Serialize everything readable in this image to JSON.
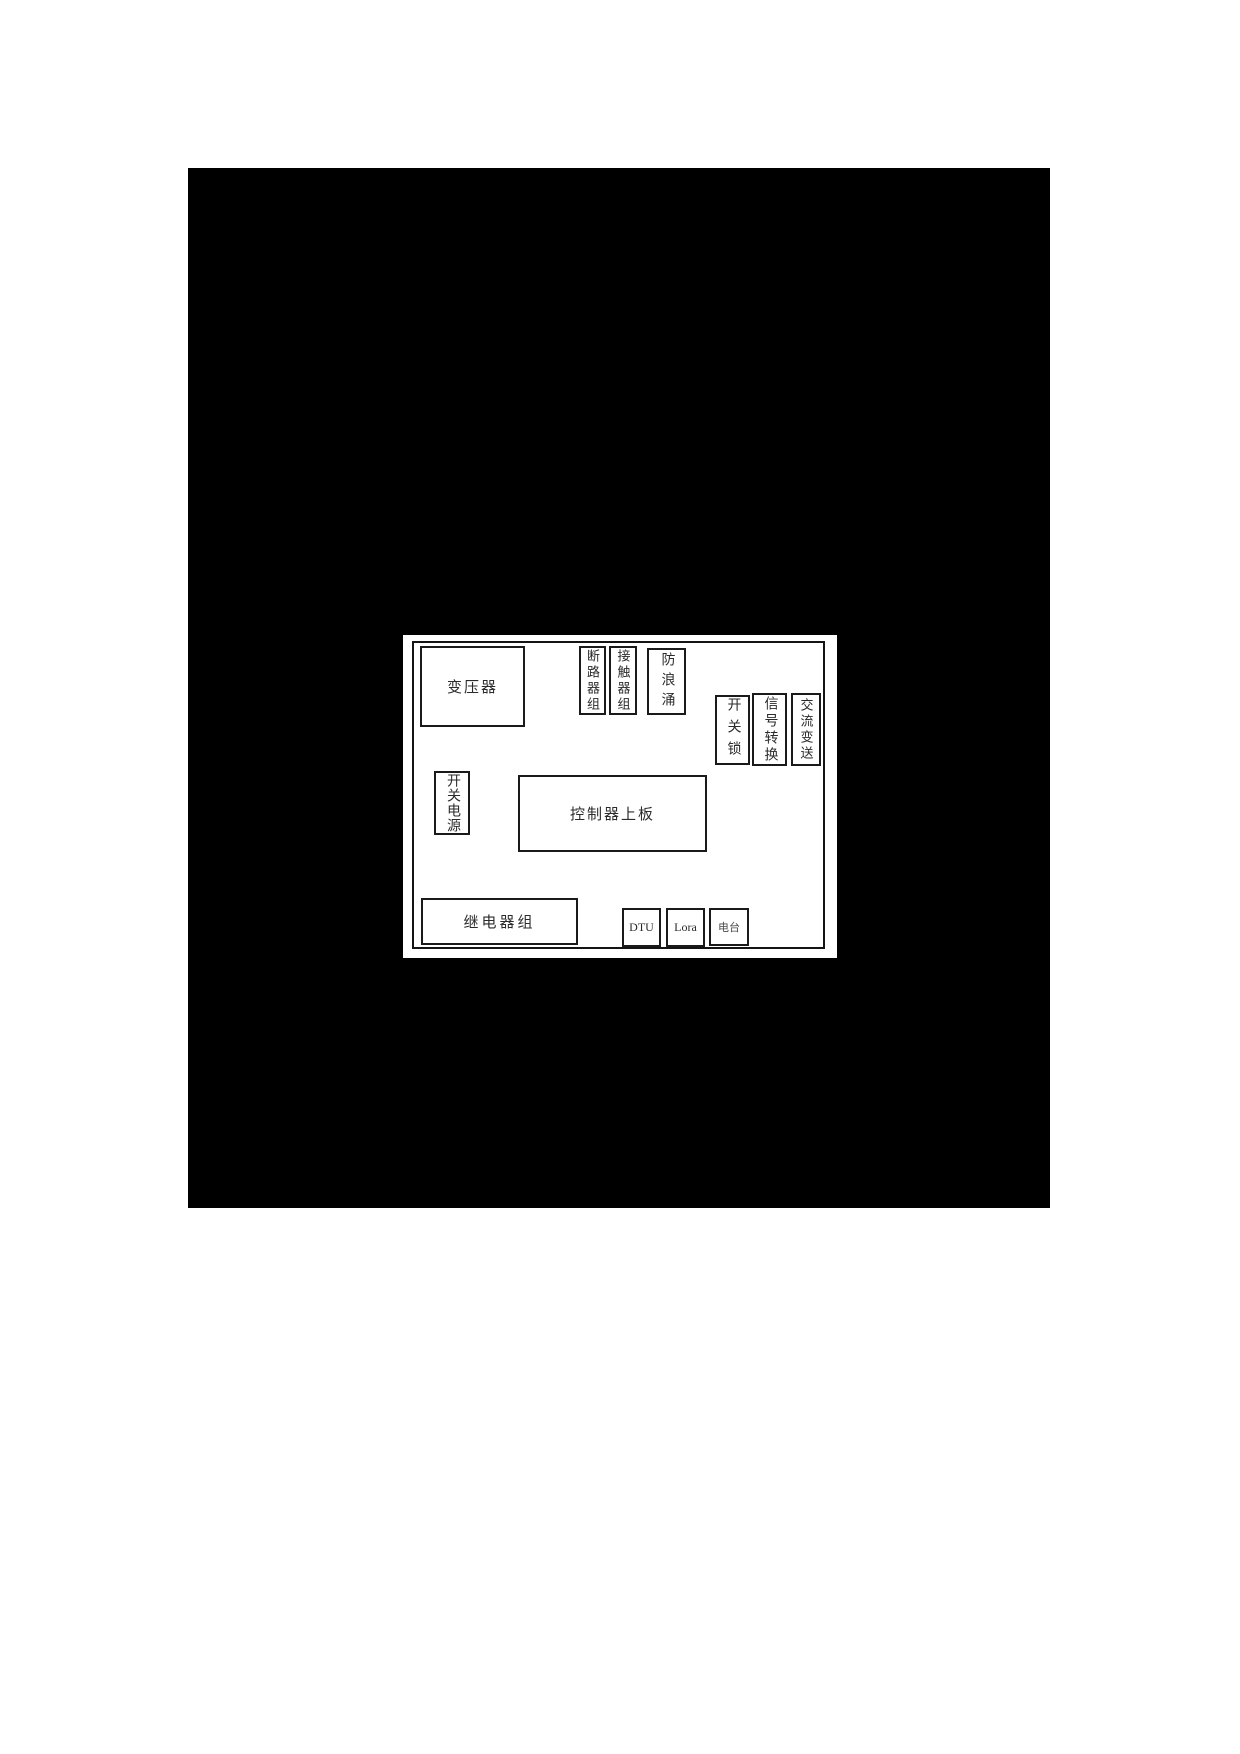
{
  "figure": {
    "background_color": "#000000",
    "panel_color": "#ffffff",
    "line_color": "#1a1a1a"
  },
  "diagram": {
    "boxes": [
      {
        "id": "transformer",
        "label": "变压器",
        "orientation": "horizontal"
      },
      {
        "id": "breaker-group",
        "label": "断路器组",
        "orientation": "vertical"
      },
      {
        "id": "contactor-group",
        "label": "接触器组",
        "orientation": "vertical"
      },
      {
        "id": "surge-protector",
        "label": "防浪涌",
        "orientation": "vertical"
      },
      {
        "id": "switch-lock",
        "label": "开关锁",
        "orientation": "vertical"
      },
      {
        "id": "signal-converter",
        "label": "信号转换",
        "orientation": "vertical"
      },
      {
        "id": "ac-transmitter",
        "label": "交流变送",
        "orientation": "vertical"
      },
      {
        "id": "switching-power",
        "label": "开关电源",
        "orientation": "vertical"
      },
      {
        "id": "controller-board",
        "label": "控制器上板",
        "orientation": "horizontal"
      },
      {
        "id": "relay-group",
        "label": "继电器组",
        "orientation": "horizontal"
      },
      {
        "id": "dtu",
        "label": "DTU",
        "orientation": "horizontal"
      },
      {
        "id": "lora",
        "label": "Lora",
        "orientation": "horizontal"
      },
      {
        "id": "radio",
        "label": "电台",
        "orientation": "horizontal"
      }
    ]
  }
}
